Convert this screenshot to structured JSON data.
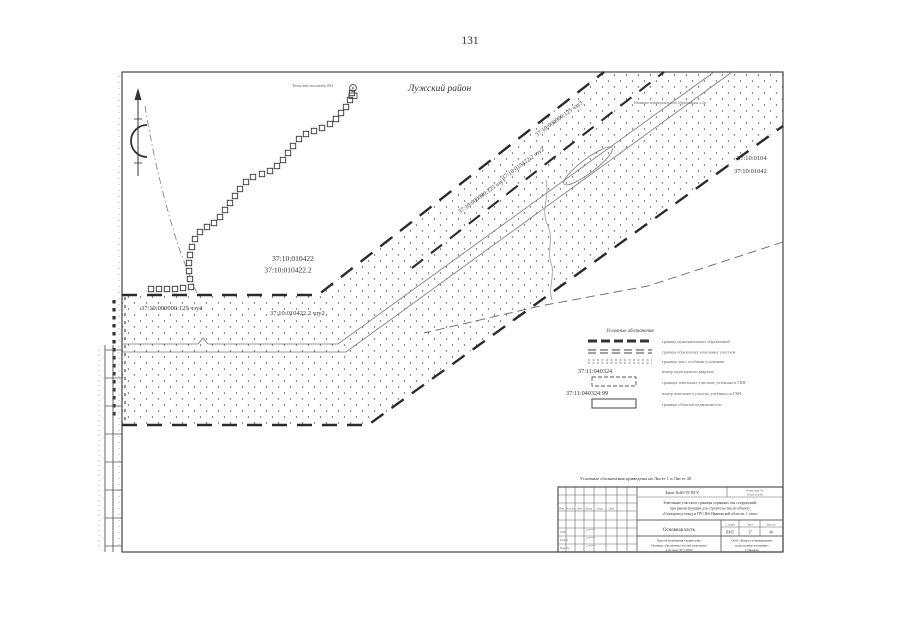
{
  "page": {
    "number": "131"
  },
  "map": {
    "district": "Лужский район",
    "top_note": "Точка вне масштаба 004",
    "top_right_note": "Название муниципального образования л.2в",
    "labels": {
      "quarter": "37:10:010422",
      "parcel2": "37:10:010422.2",
      "chzu4": "37:10:000000:125 чзу4",
      "chzu2_left": "37:10:010422.2 чзу2",
      "chzu3": "37:10:000000:125 чзу3",
      "chzu2_diag": "37:10:010422.2 чзу2",
      "chzu1": "37:10:000000:125 чзу1",
      "right_top1": "37:10:0104",
      "right_top2": "37:10:01042"
    }
  },
  "legend": {
    "title": "Условные обозначения",
    "items": [
      {
        "label": "граница муниципальных образований"
      },
      {
        "label": "граница образуемых земельных участков"
      },
      {
        "label": "границы зон с особыми условиями"
      },
      {
        "number": "37:11:040324",
        "label": "номер кадастрового квартала"
      },
      {
        "label": "границы земельных участков, учтённые в ГКН"
      },
      {
        "number": "37:11:040324:99",
        "label": "номер земельного участка, учтённого в ГКН"
      },
      {
        "label": "границы объектов недвижимости"
      }
    ]
  },
  "footnote": "Условные обозначения приведены на Листе 1 и Листе 40",
  "title_block": {
    "order": "Заказ №40-19-ПГУ",
    "inv_line1": "Взам. инв. №",
    "inv_line2": "Подп. и дата",
    "project_line1": "Земельные участки и границы охранных зон сооружений,",
    "project_line2": "при реконструкции для строительства по объекту",
    "project_line3": "«Газопровод-отвод и ГРС Юг Ивановской области, 1 этап»",
    "section": "Основная часть",
    "stage_label": "Стадия",
    "sheet_label": "Лист",
    "sheets_label": "Листов",
    "stage": "ПМТ",
    "sheet": "17",
    "sheets": "40",
    "doc_title_line1": "Чертёж межевания территории.",
    "doc_title_line2": "Границы образуемых частей земельных",
    "doc_title_line3": "участков. М 1:2000",
    "company_line1": "ООО «Недра-геоинжиниринг,",
    "company_line2": "кадастровые компании»",
    "company_line3": "г. Иваново",
    "columns": [
      "Изм.",
      "Кол.уч",
      "Лист",
      "№док.",
      "Подп.",
      "Дата"
    ],
    "staff": [
      "ГИП",
      "Разраб.",
      "Н.контр."
    ]
  }
}
